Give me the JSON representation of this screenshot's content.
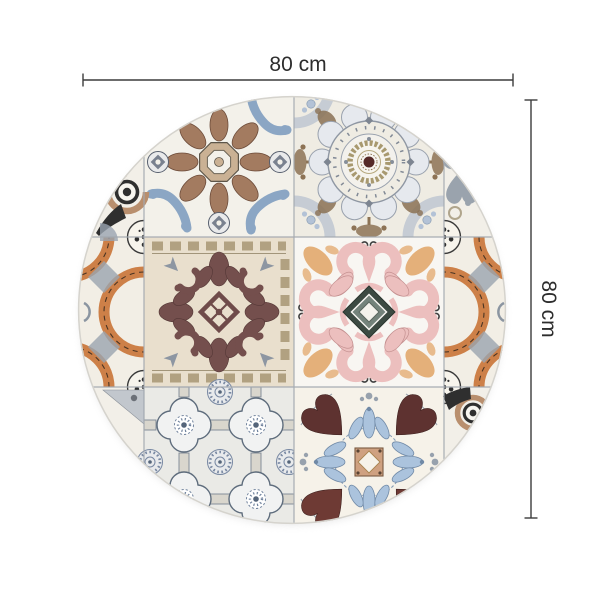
{
  "page": {
    "background_color": "#ffffff"
  },
  "dimensions": {
    "width_label": "80 cm",
    "height_label": "80 cm",
    "line_color": "#3c3c3c",
    "text_color": "#2d2d2d"
  },
  "product": {
    "shape": "round",
    "kind": "vintage-patchwork-tile-rug",
    "tiles": [
      {
        "position": "top-left",
        "pattern": "blue-brown-damask-medallion"
      },
      {
        "position": "top-right",
        "pattern": "round-rosette-medallion"
      },
      {
        "position": "middle-center",
        "pattern": "maroon-acanthus-damask"
      },
      {
        "position": "middle-right",
        "pattern": "pink-scroll-cross-dark-diamond"
      },
      {
        "position": "bottom-left",
        "pattern": "grey-quatrefoil-lattice"
      },
      {
        "position": "bottom-right",
        "pattern": "tulip-hearts-blue-fronds"
      },
      {
        "position": "left-edge",
        "pattern": "terracotta-arc-azulejo"
      },
      {
        "position": "right-edge",
        "pattern": "terracotta-arc-azulejo"
      },
      {
        "position": "top-left-edge",
        "pattern": "black-arrow-eye-motif"
      },
      {
        "position": "bottom-right-edge",
        "pattern": "black-arrow-eye-motif"
      }
    ],
    "palette": {
      "tile_background": "#f3f0e8",
      "blue": "#8ba6c4",
      "brown": "#a37b60",
      "maroon": "#6f4b4a",
      "pink": "#ecc0bf",
      "terracotta": "#cd8048",
      "slate_grey": "#8d96a2",
      "light_blue": "#abc3dd",
      "dark_heart": "#5e3230",
      "grid_line": "#a3a9b0",
      "center_diamond": "#3c4a42"
    }
  }
}
